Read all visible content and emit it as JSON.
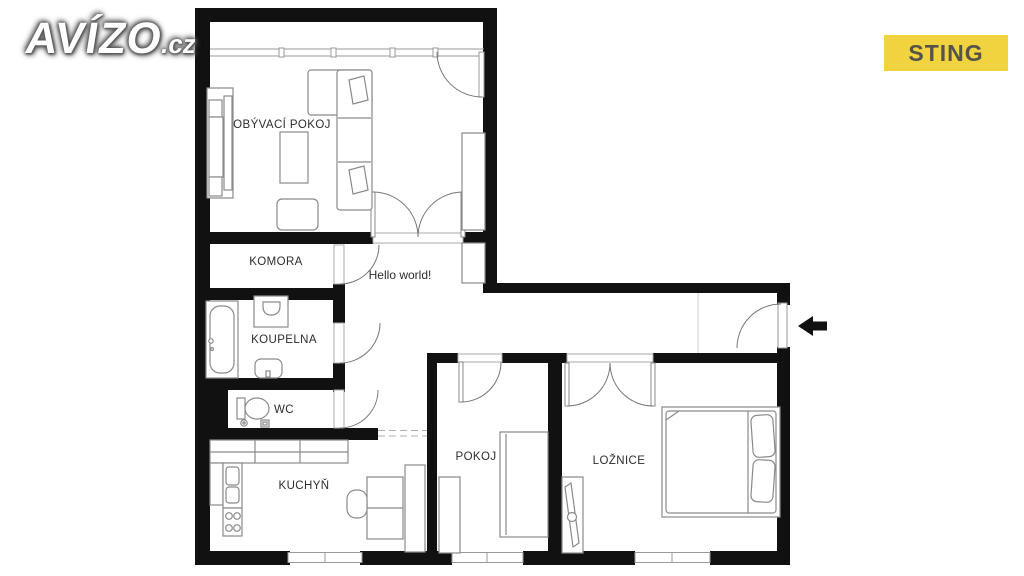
{
  "branding": {
    "logo_main": "AVÍZO",
    "logo_suffix": ".cz",
    "logo_color": "#ffffff",
    "badge_label": "STING",
    "badge_bg": "#F0D33E",
    "badge_text_color": "#55524A"
  },
  "floorplan": {
    "wall_color": "#111111",
    "furniture_stroke": "#8a8a8a",
    "window_stroke": "#999999",
    "annotation": "Hello world!",
    "entrance": {
      "arrow_direction": "left"
    },
    "rooms": [
      {
        "id": "obyvaci-pokoj",
        "label": "OBÝVACÍ POKOJ"
      },
      {
        "id": "komora",
        "label": "KOMORA"
      },
      {
        "id": "koupelna",
        "label": "KOUPELNA"
      },
      {
        "id": "wc",
        "label": "WC"
      },
      {
        "id": "kuchyn",
        "label": "KUCHYŇ"
      },
      {
        "id": "pokoj",
        "label": "POKOJ"
      },
      {
        "id": "loznice",
        "label": "LOŽNICE"
      }
    ]
  }
}
